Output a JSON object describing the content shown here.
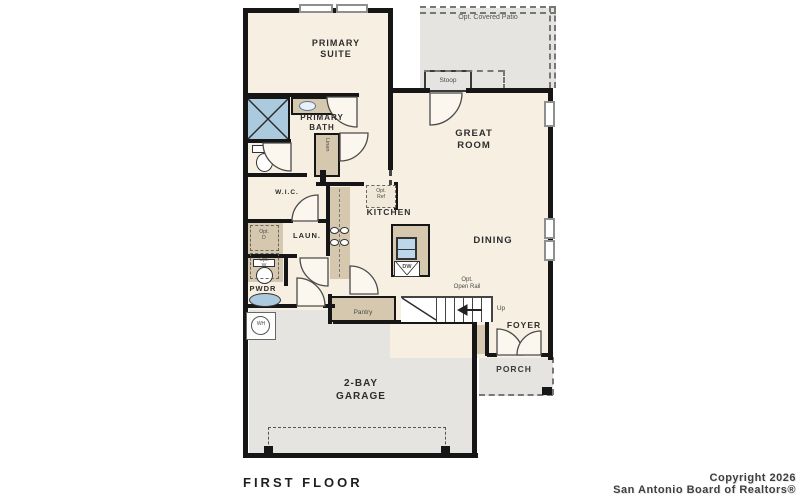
{
  "plan": {
    "title": "FIRST FLOOR",
    "copyright": {
      "line1": "Copyright 2026",
      "line2": "San Antonio Board of Realtors®"
    },
    "colors": {
      "interior_floor": "#f7f0e2",
      "exterior_concrete": "#e5e4e0",
      "cabinetry_tan": "#d6c8af",
      "fixture_blue": "#abcade",
      "wall_black": "#161616",
      "label_text": "#2d2d2d"
    },
    "rooms": {
      "patio": "Opt. Covered Patio",
      "stoop": "Stoop",
      "primary_suite_l1": "PRIMARY",
      "primary_suite_l2": "SUITE",
      "primary_bath_l1": "PRIMARY",
      "primary_bath_l2": "BATH",
      "wic": "W.I.C.",
      "great_room_l1": "GREAT",
      "great_room_l2": "ROOM",
      "kitchen": "KITCHEN",
      "dining": "DINING",
      "laundry": "LAUN.",
      "powder": "PWDR",
      "pantry": "Pantry",
      "foyer": "FOYER",
      "porch": "PORCH",
      "garage_l1": "2-BAY",
      "garage_l2": "GARAGE"
    },
    "annotations": {
      "opt_ref_l1": "Opt.",
      "opt_ref_l2": "Ref",
      "opt_dryer_l1": "Opt.",
      "opt_dryer_l2": "D",
      "opt_washer_l1": "Opt.",
      "opt_washer_l2": "W",
      "linen": "Linen",
      "water_heater": "WH",
      "dishwasher": "DW",
      "open_rail_l1": "Opt.",
      "open_rail_l2": "Open Rail",
      "up": "Up"
    }
  }
}
